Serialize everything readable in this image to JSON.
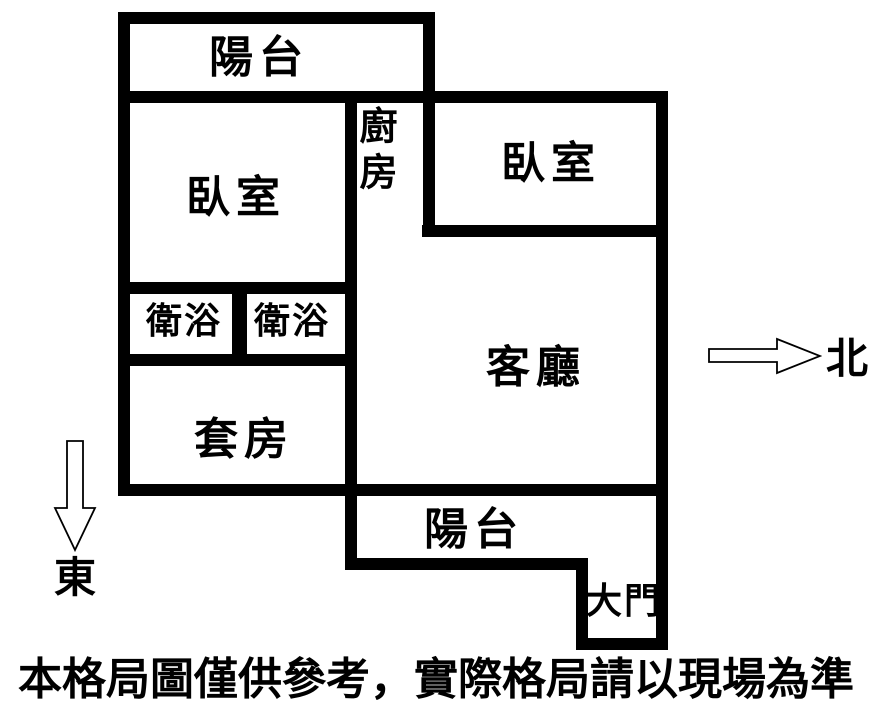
{
  "plan": {
    "balcony_top": "陽台",
    "bedroom_left": "臥室",
    "kitchen": "廚房",
    "bedroom_right": "臥室",
    "bathroom_left": "衛浴",
    "bathroom_right": "衛浴",
    "living_room": "客廳",
    "suite": "套房",
    "balcony_bottom": "陽台",
    "main_door": "大門"
  },
  "compass": {
    "north_label": "北",
    "east_label": "東"
  },
  "footer": {
    "disclaimer": "本格局圖僅供參考，實際格局請以現場為準"
  },
  "colors": {
    "wall": "#000000",
    "background": "#ffffff",
    "text": "#000000"
  }
}
